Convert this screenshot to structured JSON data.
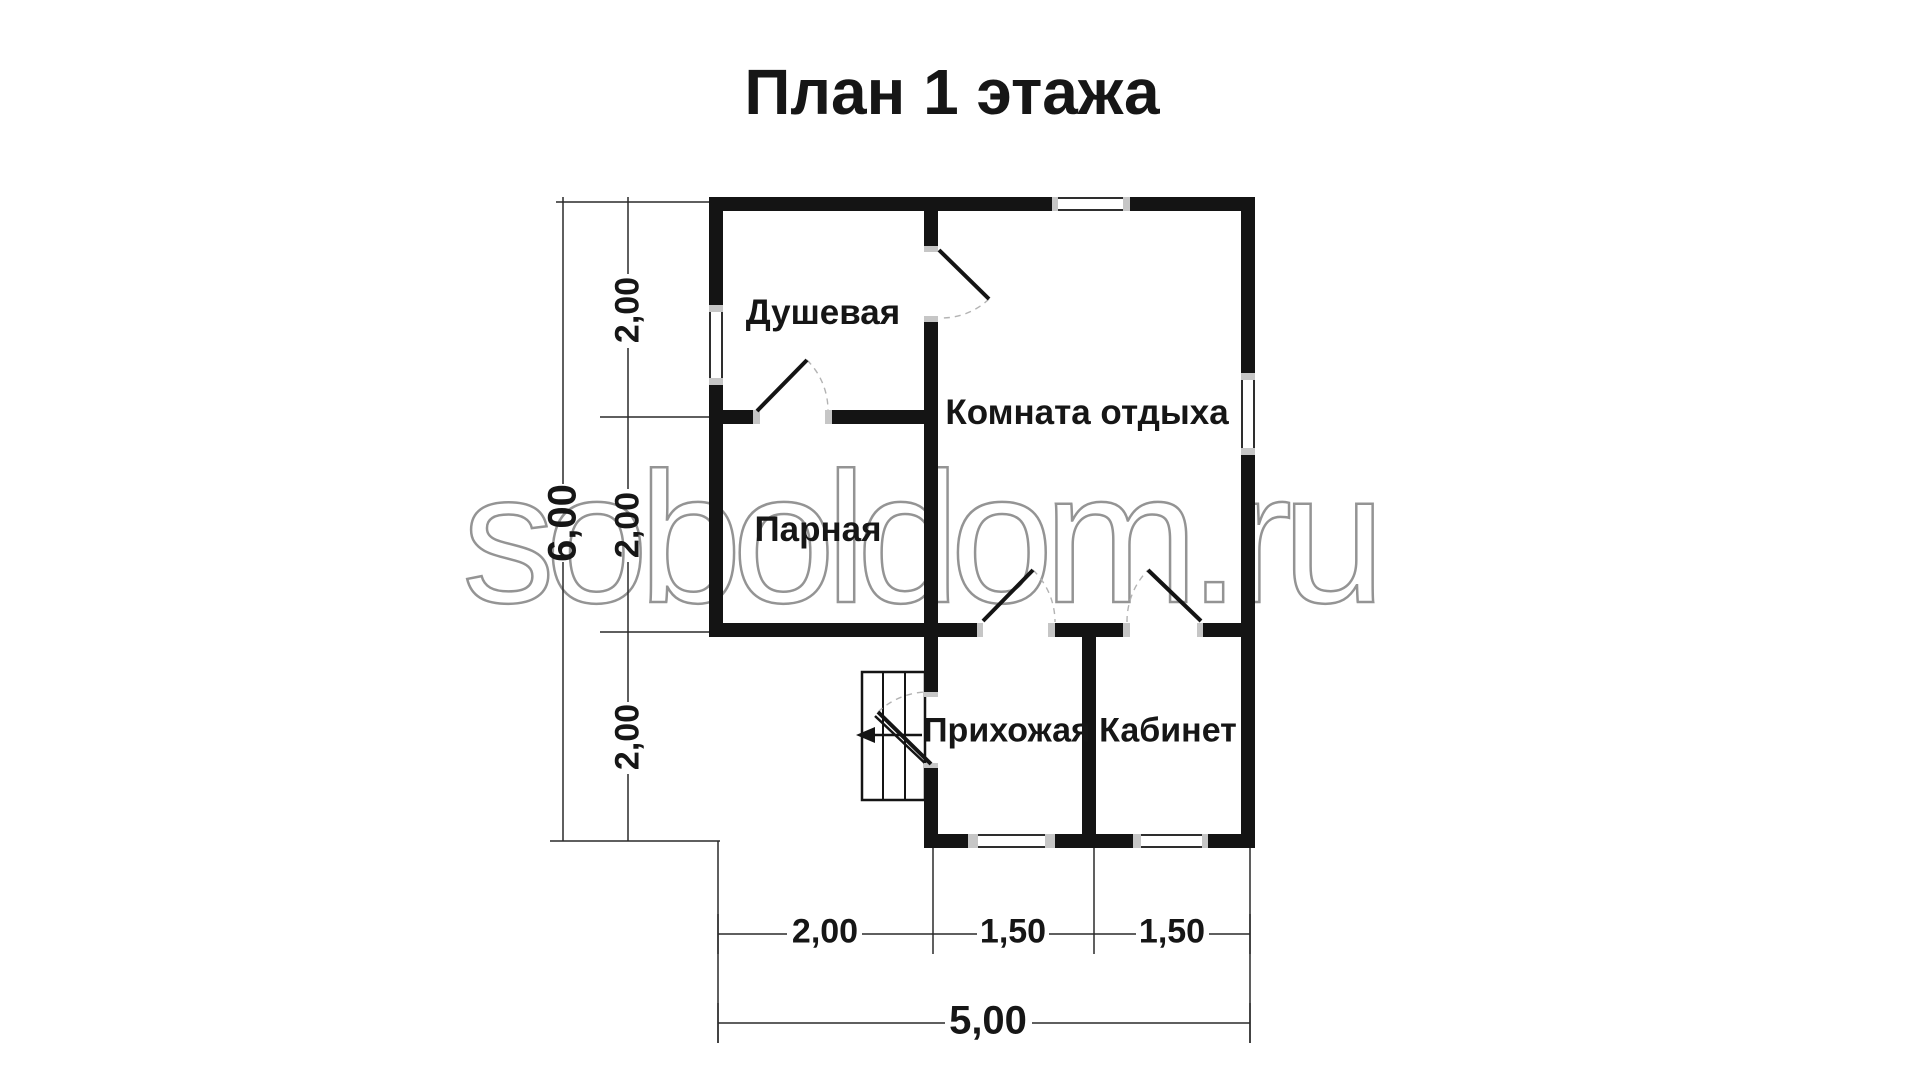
{
  "title": "План 1 этажа",
  "watermark": "soboldom.ru",
  "rooms": {
    "shower": "Душевая",
    "lounge": "Комната отдыха",
    "steam": "Парная",
    "hall": "Прихожая",
    "office": "Кабинет"
  },
  "dims": {
    "left_total": "6,00",
    "left_seg1": "2,00",
    "left_seg2": "2,00",
    "left_seg3": "2,00",
    "bottom_seg1": "2,00",
    "bottom_seg2": "1,50",
    "bottom_seg3": "1,50",
    "bottom_total": "5,00"
  }
}
